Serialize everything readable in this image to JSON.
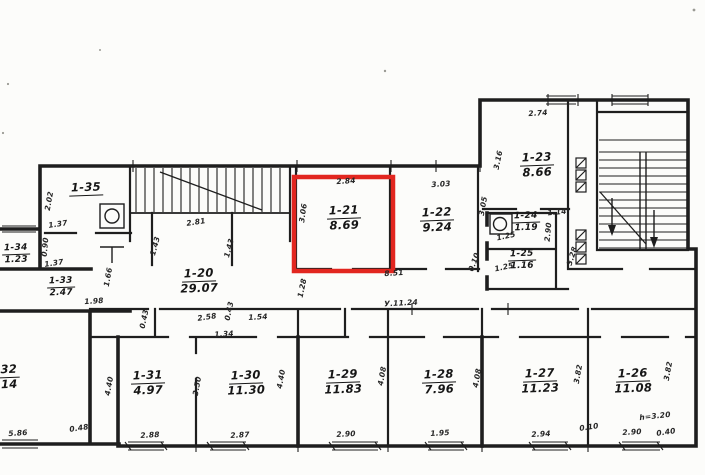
{
  "plan": {
    "type": "floor-plan scanned blueprint",
    "highlight_color": "#e2261f",
    "line_color": "#1e1e1e",
    "highlighted_room": "1-21",
    "rooms": [
      {
        "id": "1-35",
        "label": "1-35",
        "area": "",
        "x": 86,
        "y": 181,
        "small": false
      },
      {
        "id": "1-34",
        "label": "1-34",
        "area": "1.23",
        "x": 16,
        "y": 243,
        "small": true
      },
      {
        "id": "1-33",
        "label": "1-33",
        "area": "2.47",
        "x": 61,
        "y": 276,
        "small": true
      },
      {
        "id": "1-20",
        "label": "1-20",
        "area": "29.07",
        "x": 199,
        "y": 267,
        "small": false
      },
      {
        "id": "1-21",
        "label": "1-21",
        "area": "8.69",
        "x": 344,
        "y": 204,
        "small": false
      },
      {
        "id": "1-22",
        "label": "1-22",
        "area": "9.24",
        "x": 437,
        "y": 206,
        "small": false
      },
      {
        "id": "1-23",
        "label": "1-23",
        "area": "8.66",
        "x": 537,
        "y": 151,
        "small": false
      },
      {
        "id": "1-24",
        "label": "1-24",
        "area": "1.19",
        "x": 526,
        "y": 211,
        "small": true
      },
      {
        "id": "1-25",
        "label": "1-25",
        "area": "1.16",
        "x": 522,
        "y": 249,
        "small": true
      },
      {
        "id": "1-32",
        "label": "32",
        "area": "14",
        "x": 9,
        "y": 363,
        "small": false
      },
      {
        "id": "1-31",
        "label": "1-31",
        "area": "4.97",
        "x": 148,
        "y": 369,
        "small": false
      },
      {
        "id": "1-30",
        "label": "1-30",
        "area": "11.30",
        "x": 246,
        "y": 369,
        "small": false
      },
      {
        "id": "1-29",
        "label": "1-29",
        "area": "11.83",
        "x": 343,
        "y": 368,
        "small": false
      },
      {
        "id": "1-28",
        "label": "1-28",
        "area": "7.96",
        "x": 439,
        "y": 368,
        "small": false
      },
      {
        "id": "1-27",
        "label": "1-27",
        "area": "11.23",
        "x": 540,
        "y": 367,
        "small": false
      },
      {
        "id": "1-26",
        "label": "1-26",
        "area": "11.08",
        "x": 633,
        "y": 367,
        "small": false
      }
    ],
    "dims": [
      {
        "text": "2.84",
        "x": 346,
        "y": 181,
        "rot": -4
      },
      {
        "text": "3.06",
        "x": 303,
        "y": 213,
        "rot": -82
      },
      {
        "text": "3.03",
        "x": 441,
        "y": 184,
        "rot": -4
      },
      {
        "text": "3.05",
        "x": 483,
        "y": 206,
        "rot": -80
      },
      {
        "text": "0.10",
        "x": 474,
        "y": 262,
        "rot": -70
      },
      {
        "text": "8.51",
        "x": 394,
        "y": 273,
        "rot": -4
      },
      {
        "text": "У.11.24",
        "x": 401,
        "y": 303,
        "rot": -3
      },
      {
        "text": "1.28",
        "x": 302,
        "y": 288,
        "rot": -78
      },
      {
        "text": "2.74",
        "x": 538,
        "y": 113,
        "rot": -4
      },
      {
        "text": "3.16",
        "x": 498,
        "y": 160,
        "rot": -78
      },
      {
        "text": "1.14",
        "x": 557,
        "y": 212,
        "rot": -5
      },
      {
        "text": "2.90",
        "x": 548,
        "y": 232,
        "rot": -85
      },
      {
        "text": "3.28",
        "x": 572,
        "y": 256,
        "rot": -72
      },
      {
        "text": "1.25",
        "x": 506,
        "y": 236,
        "rot": -12
      },
      {
        "text": "1.25",
        "x": 504,
        "y": 267,
        "rot": -12
      },
      {
        "text": "2.81",
        "x": 196,
        "y": 222,
        "rot": -8
      },
      {
        "text": "1.43",
        "x": 155,
        "y": 246,
        "rot": -75
      },
      {
        "text": "1.43",
        "x": 229,
        "y": 248,
        "rot": -75
      },
      {
        "text": "2.02",
        "x": 49,
        "y": 201,
        "rot": -80
      },
      {
        "text": "1.37",
        "x": 58,
        "y": 224,
        "rot": -8
      },
      {
        "text": "0.90",
        "x": 45,
        "y": 247,
        "rot": -85
      },
      {
        "text": "1.37",
        "x": 54,
        "y": 263,
        "rot": -8
      },
      {
        "text": "1.98",
        "x": 94,
        "y": 301,
        "rot": -4
      },
      {
        "text": "1.66",
        "x": 108,
        "y": 277,
        "rot": -80
      },
      {
        "text": "0.43",
        "x": 144,
        "y": 319,
        "rot": -78
      },
      {
        "text": "2.58",
        "x": 207,
        "y": 317,
        "rot": -8
      },
      {
        "text": "0.43",
        "x": 229,
        "y": 311,
        "rot": -78
      },
      {
        "text": "1.34",
        "x": 224,
        "y": 334,
        "rot": -3
      },
      {
        "text": "1.54",
        "x": 258,
        "y": 317,
        "rot": -3
      },
      {
        "text": "5.86",
        "x": 18,
        "y": 433,
        "rot": -4
      },
      {
        "text": "0.48",
        "x": 79,
        "y": 428,
        "rot": -8
      },
      {
        "text": "4.40",
        "x": 109,
        "y": 386,
        "rot": -80
      },
      {
        "text": "2.88",
        "x": 150,
        "y": 435,
        "rot": -3
      },
      {
        "text": "3.50",
        "x": 197,
        "y": 386,
        "rot": -80
      },
      {
        "text": "2.87",
        "x": 240,
        "y": 435,
        "rot": -3
      },
      {
        "text": "4.40",
        "x": 281,
        "y": 379,
        "rot": -80
      },
      {
        "text": "2.90",
        "x": 346,
        "y": 434,
        "rot": -3
      },
      {
        "text": "4.08",
        "x": 382,
        "y": 376,
        "rot": -80
      },
      {
        "text": "1.95",
        "x": 440,
        "y": 433,
        "rot": -3
      },
      {
        "text": "4.08",
        "x": 477,
        "y": 378,
        "rot": -80
      },
      {
        "text": "2.94",
        "x": 541,
        "y": 434,
        "rot": -3
      },
      {
        "text": "3.82",
        "x": 578,
        "y": 374,
        "rot": -80
      },
      {
        "text": "0.10",
        "x": 589,
        "y": 427,
        "rot": -8
      },
      {
        "text": "2.90",
        "x": 632,
        "y": 432,
        "rot": -3
      },
      {
        "text": "0.40",
        "x": 666,
        "y": 432,
        "rot": -8
      },
      {
        "text": "3.82",
        "x": 668,
        "y": 371,
        "rot": -80
      },
      {
        "text": "h=3.20",
        "x": 655,
        "y": 416,
        "rot": -6
      }
    ]
  }
}
